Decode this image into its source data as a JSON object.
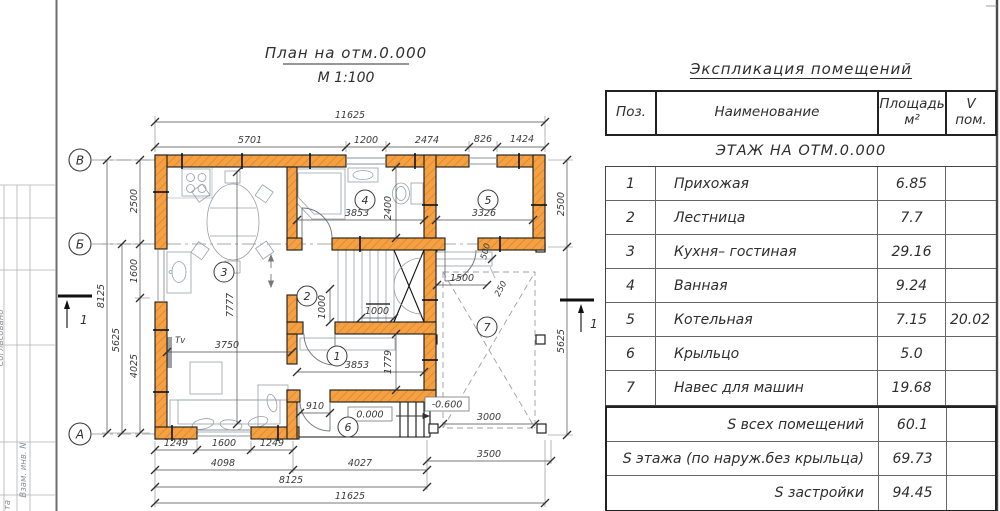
{
  "frame": {
    "side_top": "Согласовано",
    "side_mid": "Взам. инв. N",
    "side_bottom": "та"
  },
  "plan": {
    "title": "План на отм.0.000",
    "scale": "М 1:100",
    "axes": [
      "В",
      "Б",
      "А"
    ],
    "section_mark": "1",
    "rooms": [
      "1",
      "2",
      "3",
      "4",
      "5",
      "6",
      "7"
    ],
    "levels": {
      "zero": "0.000",
      "minus": "-0.600"
    },
    "tv": "Tv",
    "dims": {
      "top_total": "11625",
      "top": [
        "5701",
        "1200",
        "2474",
        "826",
        "1424"
      ],
      "left_total": "8125",
      "left_5625": "5625",
      "left": [
        "2500",
        "1600",
        "4025"
      ],
      "right_2500": "2500",
      "right_5625": "5625",
      "bottom": [
        "1249",
        "1600",
        "1249"
      ],
      "b4098": "4098",
      "b4027": "4027",
      "b3500": "3500",
      "b8125": "8125",
      "b11625": "11625",
      "k7777": "7777",
      "k3750": "3750",
      "bath_w": "3853",
      "bath_d": "2400",
      "boiler_w": "3326",
      "s1000a": "1000",
      "s1000b": "1000",
      "hall_w": "3853",
      "hall_d": "1779",
      "porch_910": "910",
      "c1500": "1500",
      "c500": "500",
      "c250": "250",
      "c3000": "3000"
    }
  },
  "table": {
    "title": "Экспликация помещений",
    "columns": {
      "pos": "Поз.",
      "name": "Наименование",
      "area": "Площадь",
      "area_unit": "м²",
      "v": "V",
      "v_unit": "пом."
    },
    "section": "ЭТАЖ НА ОТМ.0.000",
    "rows": [
      {
        "pos": "1",
        "name": "Прихожая",
        "area": "6.85",
        "v": ""
      },
      {
        "pos": "2",
        "name": "Лестница",
        "area": "7.7",
        "v": ""
      },
      {
        "pos": "3",
        "name": "Кухня– гостиная",
        "area": "29.16",
        "v": ""
      },
      {
        "pos": "4",
        "name": "Ванная",
        "area": "9.24",
        "v": ""
      },
      {
        "pos": "5",
        "name": "Котельная",
        "area": "7.15",
        "v": "20.02"
      },
      {
        "pos": "6",
        "name": "Крыльцо",
        "area": "5.0",
        "v": ""
      },
      {
        "pos": "7",
        "name": "Навес для машин",
        "area": "19.68",
        "v": ""
      }
    ],
    "totals": [
      {
        "label": "S всех помещений",
        "value": "60.1"
      },
      {
        "label": "S этажа (по наруж.без крыльца)",
        "value": "69.73"
      },
      {
        "label": "S застройки",
        "value": "94.45"
      }
    ]
  }
}
